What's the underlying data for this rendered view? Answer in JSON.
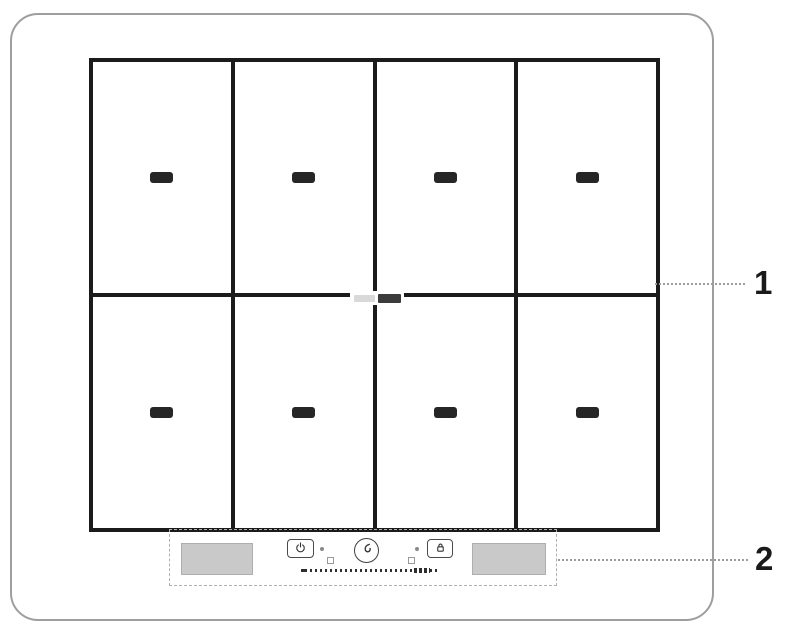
{
  "callouts": [
    {
      "label": "1"
    },
    {
      "label": "2"
    }
  ],
  "cooktop": {
    "grid": {
      "rows": 2,
      "columns": 4
    },
    "zones": [
      {
        "mark": "zone-dash"
      },
      {
        "mark": "zone-dash"
      },
      {
        "mark": "zone-dash"
      },
      {
        "mark": "zone-dash"
      },
      {
        "mark": "zone-dash"
      },
      {
        "mark": "zone-dash"
      },
      {
        "mark": "zone-dash"
      },
      {
        "mark": "zone-dash"
      }
    ],
    "brand_logo": {
      "segments": [
        "light-segment",
        "dark-segment"
      ]
    }
  },
  "control_panel": {
    "display_pads": [
      {
        "side": "left"
      },
      {
        "side": "right"
      }
    ],
    "buttons": [
      {
        "icon": "power-icon"
      },
      {
        "icon": "dial-icon"
      },
      {
        "icon": "lock-icon"
      }
    ],
    "indicator_dots": 2,
    "marker_squares": 2,
    "slider_tick_marks": 26
  },
  "colors": {
    "background": "#ffffff",
    "outer_border": "#9e9e9e",
    "grid_line": "#1b1b1b",
    "zone_mark": "#262626",
    "panel_fill": "#c9c9c9",
    "panel_stroke": "#aeaeae",
    "dashed_outline": "#b0b0b0",
    "leader_line": "#9c9c9c",
    "callout_text": "#1a1a1a"
  }
}
